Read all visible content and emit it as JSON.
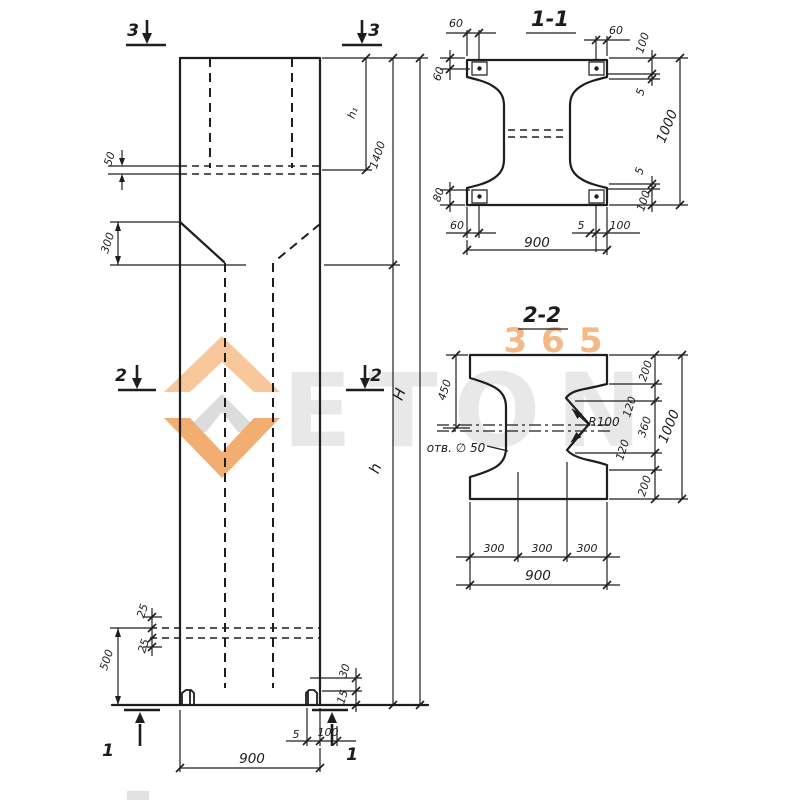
{
  "colors": {
    "ink": "#1e1e1e",
    "accent_orange": "#f0a35f",
    "watermark_gray": "#e7e7e7",
    "background": "#ffffff"
  },
  "watermark": {
    "digits": "365",
    "brand": "ETON"
  },
  "elevation": {
    "marks": {
      "top": "3",
      "middle": "2",
      "bottom": "1"
    },
    "dims": {
      "pocket_wall": "50",
      "taper": "300",
      "pocket_depth": "h₁",
      "head_length": "1400",
      "shaft_length": "h",
      "total_length": "H",
      "tip_offset_a": "25",
      "tip_offset_b": "25",
      "tip_length": "500",
      "foot_height": "30",
      "foot_lip": "15",
      "foot_gap": "5",
      "foot_width": "100",
      "width": "900"
    }
  },
  "section_1_1": {
    "title": "1-1",
    "dims": {
      "cover": "60",
      "cover_bottom": "80",
      "gap": "5",
      "flange": "100",
      "width": "900",
      "height": "1000"
    }
  },
  "section_2_2": {
    "title": "2-2",
    "dims": {
      "flange_top": "450",
      "hole": "отв. ∅ 50",
      "radius": "R100",
      "chamfer": "120",
      "web": "360",
      "edge": "200",
      "third": "300",
      "width": "900",
      "height": "1000"
    }
  }
}
